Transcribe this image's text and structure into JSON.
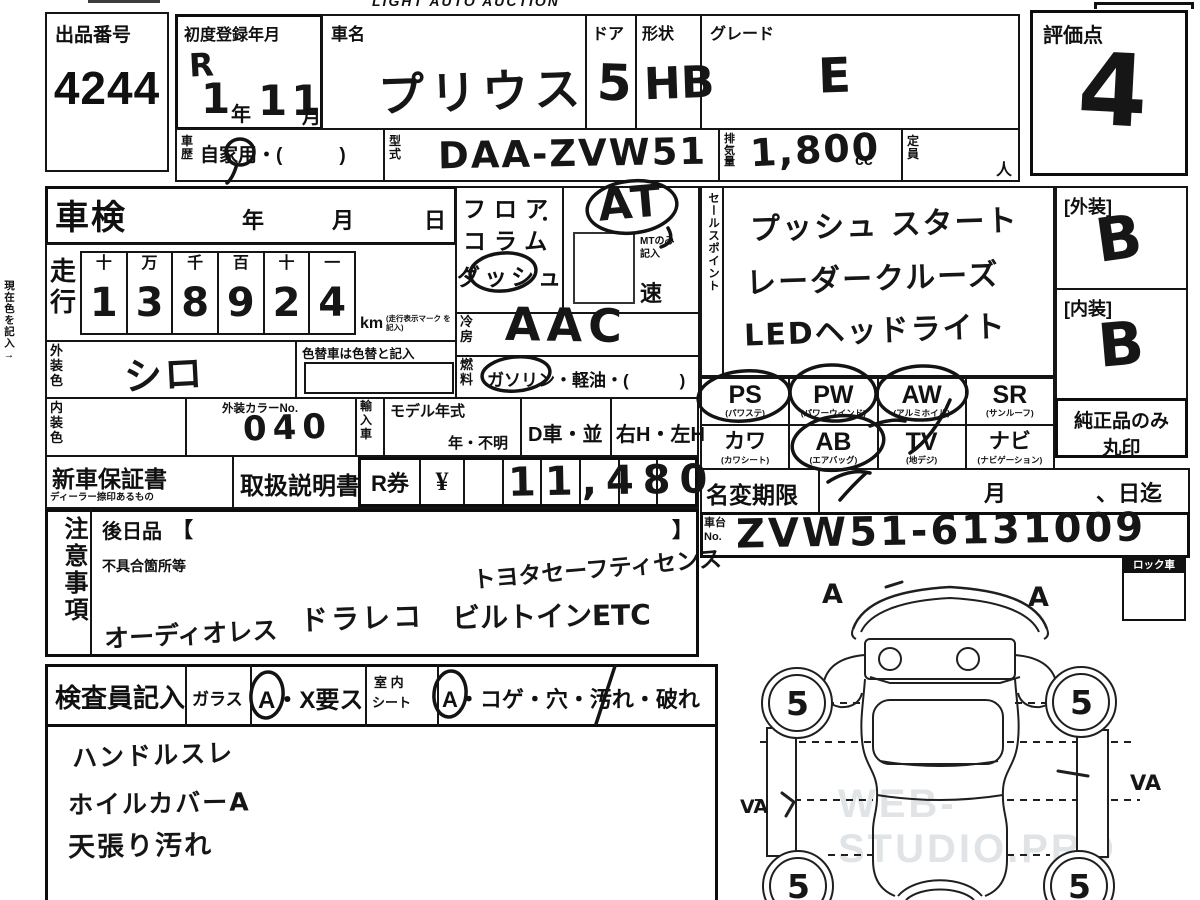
{
  "header": {
    "title": "LIGHT AUTO AUCTION"
  },
  "lot": {
    "label": "出品番号",
    "number": "4244"
  },
  "registration": {
    "label": "初度登録年月",
    "era": "R",
    "year": "1",
    "year_unit": "年",
    "month": "11",
    "month_unit": "月"
  },
  "car": {
    "name_label": "車名",
    "name": "プリウス",
    "doors_label": "ドア",
    "doors": "5",
    "shape_label": "形状",
    "shape": "HB",
    "grade_label": "グレード",
    "grade": "E",
    "history_label": "車歴",
    "history": "自家用・(　　　)",
    "model_code_label": "型式",
    "model_code": "DAA-ZVW51",
    "displacement_label": "排気量",
    "displacement": "1,800",
    "displacement_unit": "cc",
    "capacity_label": "定員",
    "capacity_unit": "人"
  },
  "score": {
    "label": "評価点",
    "value": "4"
  },
  "grades": {
    "exterior_label": "[外装]",
    "exterior": "B",
    "interior_label": "[内装]",
    "interior": "B",
    "genuine_note1": "純正品のみ",
    "genuine_note2": "丸印"
  },
  "margin_note": "現在色を記入→",
  "shaken": {
    "label": "車検",
    "year": "年",
    "month": "月",
    "day": "日"
  },
  "mileage": {
    "label": "走行",
    "headers": [
      "十",
      "万",
      "千",
      "百",
      "十",
      "一"
    ],
    "digits": [
      "1",
      "3",
      "8",
      "9",
      "2",
      "4"
    ],
    "unit": "km",
    "unit_note": "(走行表示マーク を記入)"
  },
  "exterior_color": {
    "label": "外装色",
    "value": "シロ",
    "recolor_note": "色替車は色替と記入"
  },
  "interior_color": {
    "label": "内装色",
    "color_no_label": "外装カラーNo.",
    "color_no": "040"
  },
  "import_label": "輸入車",
  "model_year": {
    "label": "モデル年式",
    "options": "年・不明"
  },
  "dealer_car": "D車・並",
  "handle": "右H・左H",
  "transmission": {
    "floor": "フロア",
    "dot": "・",
    "column": "コラム",
    "dash": "ダッシュ",
    "value": "AT",
    "mt_note1": "MTのみ",
    "mt_note2": "記入",
    "speed": "速"
  },
  "aircon": {
    "label": "冷房",
    "value": "AAC"
  },
  "fuel": {
    "label": "燃料",
    "options": "ガソリン・軽油・(　　　)"
  },
  "sales_points": {
    "label": "セールスポイント",
    "items": [
      "プッシュ スタート",
      "レーダークルーズ",
      "LEDヘッドライト"
    ]
  },
  "equipment": {
    "row1": [
      {
        "code": "PS",
        "sub": "(パワステ)"
      },
      {
        "code": "PW",
        "sub": "(パワーウインド)"
      },
      {
        "code": "AW",
        "sub": "(アルミホイル)"
      },
      {
        "code": "SR",
        "sub": "(サンルーフ)"
      }
    ],
    "row2": [
      {
        "code": "カワ",
        "sub": "(カワシート)"
      },
      {
        "code": "AB",
        "sub": "(エアバッグ)"
      },
      {
        "code": "TV",
        "sub": "(地デジ)"
      },
      {
        "code": "ナビ",
        "sub": "(ナビゲーション)"
      }
    ]
  },
  "warranty": {
    "label": "新車保証書",
    "sub": "ディーラー捺印あるもの"
  },
  "manual": {
    "label": "取扱説明書"
  },
  "recycle": {
    "label": "R券",
    "currency": "¥",
    "amount": "11,480"
  },
  "name_change": {
    "label": "名変期限",
    "month": "月",
    "day": "、日迄"
  },
  "chassis": {
    "label_top": "車台",
    "label_bottom": "No.",
    "value": "ZVW51-6131009"
  },
  "notes": {
    "label": "注意事項",
    "later_items_label": "後日品",
    "bracket_open": "【",
    "bracket_close": "】",
    "defects_label": "不具合箇所等",
    "hw1": "トヨタセーフティセンス",
    "hw2": "ドラレコ",
    "hw3": "ビルトインETC",
    "hw4": "オーディオレス"
  },
  "inspector": {
    "label": "検査員記入",
    "glass_label": "ガラス",
    "glass_value": "A・X要ス",
    "seat_label_top": "室 内",
    "seat_label_bottom": "シート",
    "seat_value": "A・コゲ・穴・汚れ・破れ",
    "notes": [
      "ハンドルスレ",
      "ホイルカバーA",
      "天張り汚れ"
    ]
  },
  "lock_box": {
    "label": "ロック車"
  },
  "diagram": {
    "front_left_mark": "A",
    "front_right_mark": "A",
    "left_mark": "VA",
    "right_mark": "VA",
    "wheel_marks": [
      "5",
      "5",
      "5",
      "5"
    ]
  },
  "watermark": "WEB-STUDIO.PRO",
  "colors": {
    "ink": "#111111",
    "paper": "#ffffff",
    "watermark": "#cdd3d6"
  }
}
